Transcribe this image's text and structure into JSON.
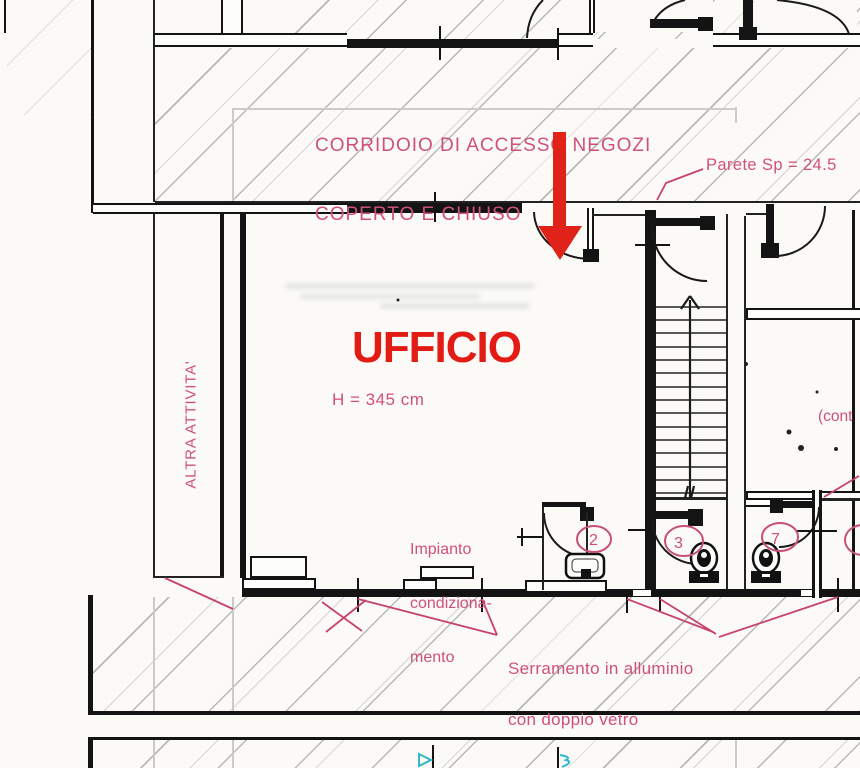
{
  "drawing_type": "floor-plan scan",
  "colors": {
    "annotation_pink": "#d0507c",
    "leader_pink": "#c64271",
    "title_red": "#e31b15",
    "arrow_red": "#e02219",
    "cyan_mark": "#2fb7cc",
    "wall_black": "#141414",
    "hatch_gray": "#8c8c8c",
    "paper": "#fbfaf7"
  },
  "labels": {
    "corridor_line1": "CORRIDOIO DI ACCESSO NEGOZI",
    "corridor_line2": "COPERTO E CHIUSO",
    "wall_thickness_note": "Parete Sp = 24.5",
    "room_title": "UFFICIO",
    "ceiling_height_note": "H = 345 cm",
    "adjacent_room": "ALTRA ATTIVITA'",
    "hvac_line1": "Impianto",
    "hvac_line2": "condiziona-",
    "hvac_line3": "mento",
    "window_line1": "Serramento in alluminio",
    "window_line2": "con doppio vetro",
    "continuation_note": "(cont",
    "room_number_2": "2",
    "room_number_3": "3",
    "room_number_7": "7"
  }
}
